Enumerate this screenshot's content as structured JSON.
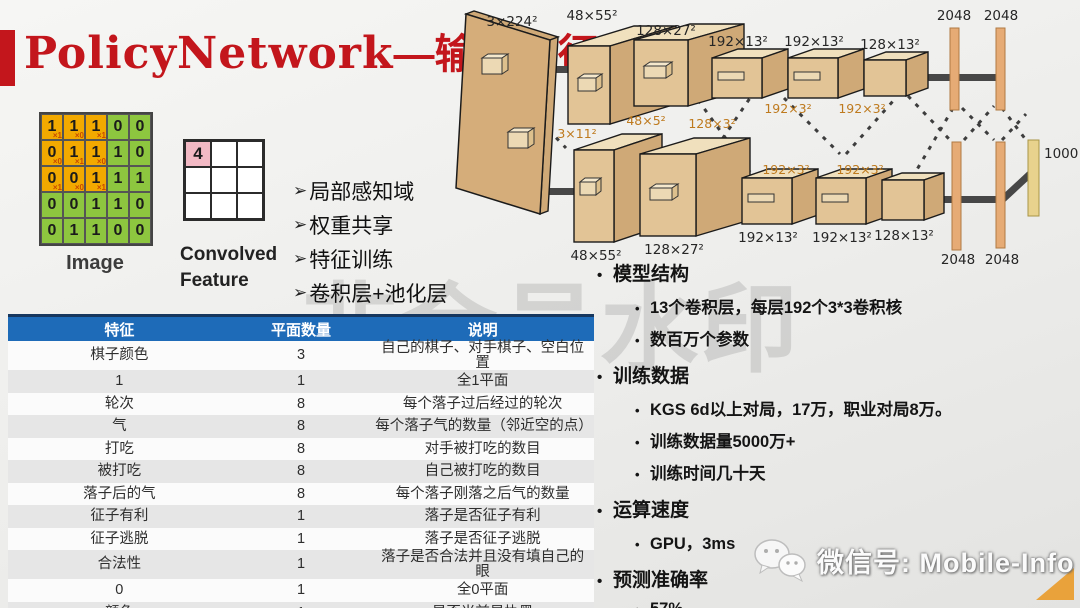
{
  "slide": {
    "title_en": "PolicyNetwork",
    "title_cn": "—输入特征",
    "watermark_center": "非会员水印",
    "wechat_label": "微信号: Mobile-Info"
  },
  "colors": {
    "title_red": "#C3161C",
    "table_header_blue": "#1E6BB8",
    "table_header_navy": "#17375E",
    "grid_orange": "#F2A900",
    "grid_green": "#8DC63F",
    "convolved_pink": "#F2B9C4",
    "corner_orange": "#E9A23B"
  },
  "conv_demo": {
    "image_label": "Image",
    "convolved_label": "Convolved Feature",
    "grid": [
      [
        "1",
        "1",
        "1",
        "0",
        "0"
      ],
      [
        "0",
        "1",
        "1",
        "1",
        "0"
      ],
      [
        "0",
        "0",
        "1",
        "1",
        "1"
      ],
      [
        "0",
        "0",
        "1",
        "1",
        "0"
      ],
      [
        "0",
        "1",
        "1",
        "0",
        "0"
      ]
    ],
    "kernel_marks": [
      [
        "×1",
        "×0",
        "×1"
      ],
      [
        "×0",
        "×1",
        "×0"
      ],
      [
        "×1",
        "×0",
        "×1"
      ]
    ],
    "convolved_value": "4"
  },
  "left_bullets": {
    "marker": "➢",
    "items": [
      "局部感知域",
      "权重共享",
      "特征训练",
      "卷积层+池化层"
    ]
  },
  "feature_table": {
    "headers": [
      "特征",
      "平面数量",
      "说明"
    ],
    "rows": [
      [
        "棋子颜色",
        "3",
        "自己的棋子、对手棋子、空白位置"
      ],
      [
        "1",
        "1",
        "全1平面"
      ],
      [
        "轮次",
        "8",
        "每个落子过后经过的轮次"
      ],
      [
        "气",
        "8",
        "每个落子气的数量（邻近空的点）"
      ],
      [
        "打吃",
        "8",
        "对手被打吃的数目"
      ],
      [
        "被打吃",
        "8",
        "自己被打吃的数目"
      ],
      [
        "落子后的气",
        "8",
        "每个落子刚落之后气的数量"
      ],
      [
        "征子有利",
        "1",
        "落子是否征子有利"
      ],
      [
        "征子逃脱",
        "1",
        "落子是否征子逃脱"
      ],
      [
        "合法性",
        "1",
        "落子是否合法并且没有填自己的眼"
      ],
      [
        "0",
        "1",
        "全0平面"
      ],
      [
        "颜色",
        "1",
        "是否当前是执黑"
      ]
    ]
  },
  "right_bullets": {
    "marker": "•",
    "groups": [
      {
        "label": "模型结构",
        "children": [
          "13个卷积层，每层192个3*3卷积核",
          "数百万个参数"
        ]
      },
      {
        "label": "训练数据",
        "children": [
          "KGS 6d以上对局，17万，职业对局8万。",
          "训练数据量5000万+",
          "训练时间几十天"
        ]
      },
      {
        "label": "运算速度",
        "children": [
          "GPU，3ms"
        ]
      },
      {
        "label": "预测准确率",
        "children": [
          "57%"
        ]
      }
    ]
  },
  "network_diagram": {
    "input_label": "3×224²",
    "top_layers": [
      "48×55²",
      "128×27²",
      "192×13²",
      "192×13²",
      "128×13²"
    ],
    "bottom_layers": [
      "48×55²",
      "128×27²",
      "192×13²",
      "192×13²",
      "128×13²"
    ],
    "top_kernels": [
      "48×5²",
      "128×3²",
      "192×3²",
      "192×3²"
    ],
    "bottom_kernels": [
      "3×11²",
      "48×5²",
      "128×3²",
      "192×3²",
      "192×3²"
    ],
    "fc_top": [
      "2048",
      "2048"
    ],
    "fc_bottom": [
      "2048",
      "2048"
    ],
    "output_label": "1000"
  }
}
